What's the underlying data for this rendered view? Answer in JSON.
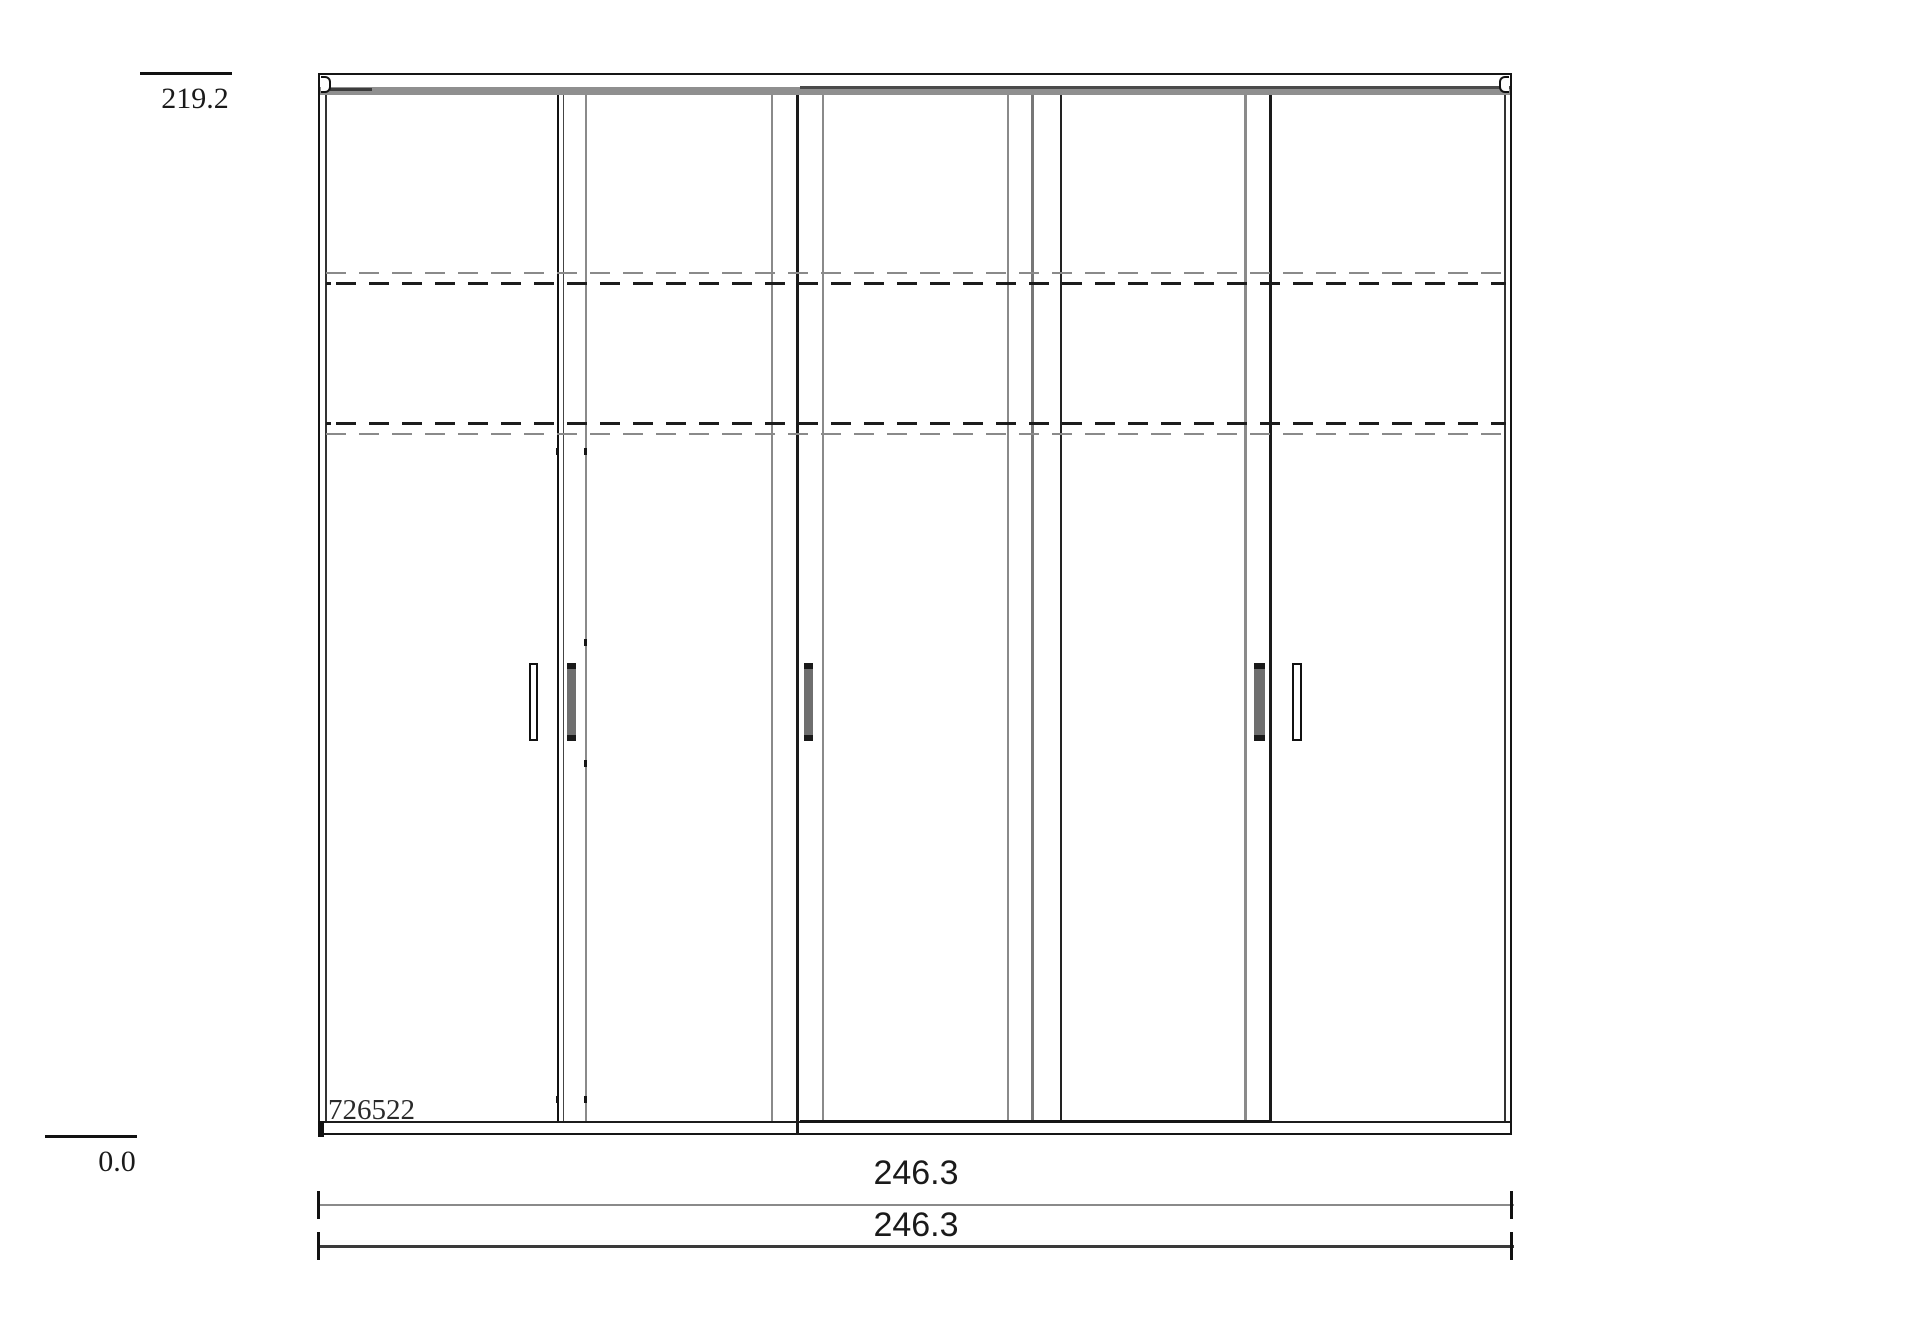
{
  "page": {
    "background": "#ffffff"
  },
  "drawing": {
    "item_number": "726522",
    "vertical_scale": {
      "top_label": "219.2",
      "bottom_label": "0.0"
    },
    "width_dimensions": {
      "primary": "246.3",
      "secondary": "246.3"
    },
    "colors": {
      "outline": "#151515",
      "top_rail_gray": "#8f8f8f",
      "hidden_line_gray": "#8a8a8a",
      "hidden_line_dark": "#1c1c1c",
      "dimension_line_gray": "#8a8a8a",
      "dimension_line_dark": "#3a3a3a",
      "handle_gray": "#6f6f6f"
    }
  }
}
